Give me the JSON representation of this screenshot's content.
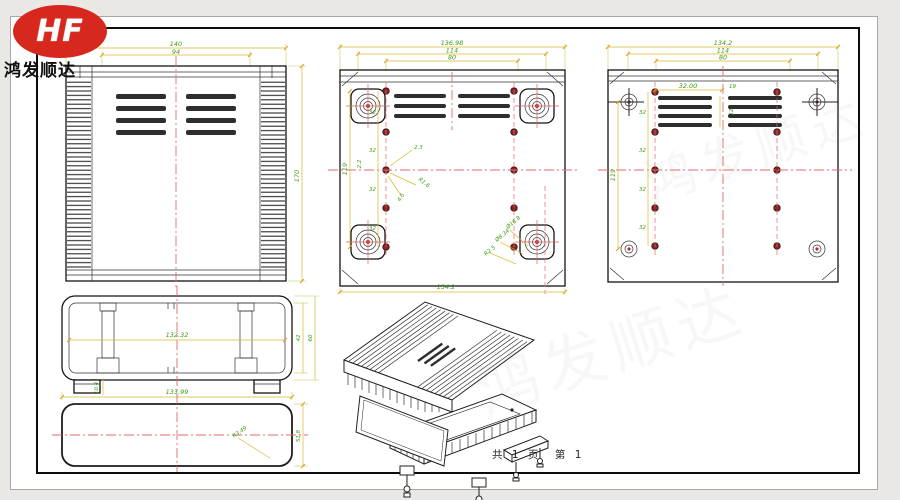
{
  "logo": {
    "brand": "HF",
    "company": "鸿发顺达"
  },
  "footer": {
    "page_info": "共 1 页　第 1"
  },
  "watermark": {
    "text": "鸿发顺达"
  },
  "colors": {
    "logo_red": "#d7281e",
    "dim_line": "#d9b62e",
    "dim_text": "#3f9c13",
    "centerline_red": "#e06a6a",
    "screw_dot": "#8c2525",
    "hatch_yellow": "#cfc63a",
    "line_black": "#222222"
  },
  "front_view": {
    "width": "140",
    "inner_width": "94",
    "height": "170"
  },
  "back_view": {
    "width": "136.98",
    "hole_span": "114",
    "slot_span": "80",
    "height": "119",
    "bottom_width": "134.2",
    "pitch": "32",
    "offset": "2.2",
    "gap": "2.3",
    "fillet": "R1.6",
    "hole": "4.5",
    "boss_od": "Ø16.8",
    "boss_id": "Ø8.34",
    "boss_r": "R2.5"
  },
  "right_view": {
    "width": "134.2",
    "hole_span": "114",
    "slot_span": "80",
    "height": "119",
    "slot_dim": "32.00",
    "center_gap": "19",
    "pitch": "32",
    "slot_h": "12"
  },
  "section_view": {
    "inner_width": "132.32",
    "outer_width": "133.99",
    "inner_height": "42",
    "outer_height": "60",
    "foot_height": "10.4"
  },
  "bottom_view": {
    "height": "51.8",
    "corner_radius": "R3.49"
  }
}
